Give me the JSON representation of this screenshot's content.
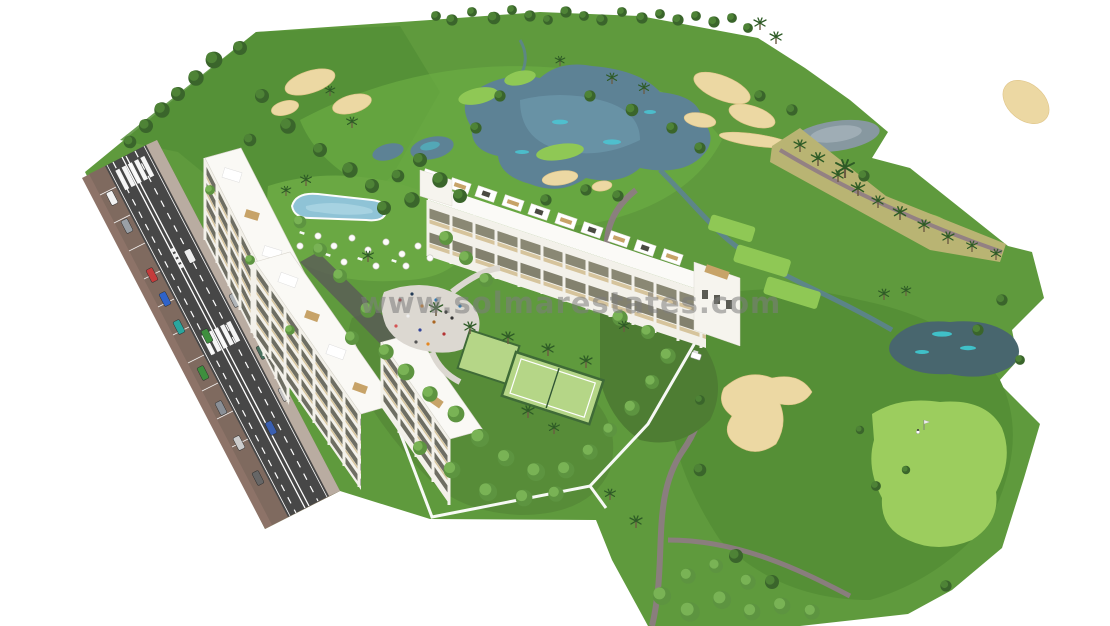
{
  "image": {
    "kind": "architectural aerial 3D render",
    "subject": "New-build apartment complex beside a golf course resort",
    "width": 1110,
    "height": 626,
    "background": "#ffffff"
  },
  "watermark": {
    "text": "www.solmarestates.com",
    "color": "#7d7d7d",
    "opacity": 0.55
  },
  "palette": {
    "fairway": "#5f9a3d",
    "fairway_dark": "#548f36",
    "fairway_light": "#7fbf4c",
    "putting_green": "#9ccd5e",
    "sand_bunker": "#ecd8a3",
    "lake_water": "#5d8295",
    "pond_water": "#48666e",
    "water_highlight": "#49cbd8",
    "asphalt": "#474747",
    "sidewalk": "#8d7368",
    "cart_path": "#8f7b85",
    "scrub": "#b9b473",
    "building_white": "#f3f1ea",
    "balcony_beige": "#d6c49c",
    "window_dark": "#6e6e63",
    "pool_blue": "#8fc3d6",
    "court_green": "#b5d687"
  },
  "scene": {
    "elements": [
      "golf-course",
      "fairways",
      "putting-green",
      "tee-boxes",
      "sand-bunkers",
      "lake",
      "pond",
      "stream",
      "cart-paths",
      "scrub-edge",
      "palm-trees",
      "trees",
      "access-road",
      "parking-bays",
      "crosswalks",
      "cars",
      "sidewalks",
      "apartment-block-a",
      "apartment-block-b",
      "apartment-block-c",
      "apartment-block-d",
      "end-tower",
      "rooftop-terraces",
      "swimming-pool",
      "pool-umbrellas",
      "sun-loungers",
      "plaza",
      "people",
      "paddle-court",
      "gardens",
      "perimeter-wall",
      "golfer",
      "pin-flag",
      "golf-cart"
    ]
  }
}
